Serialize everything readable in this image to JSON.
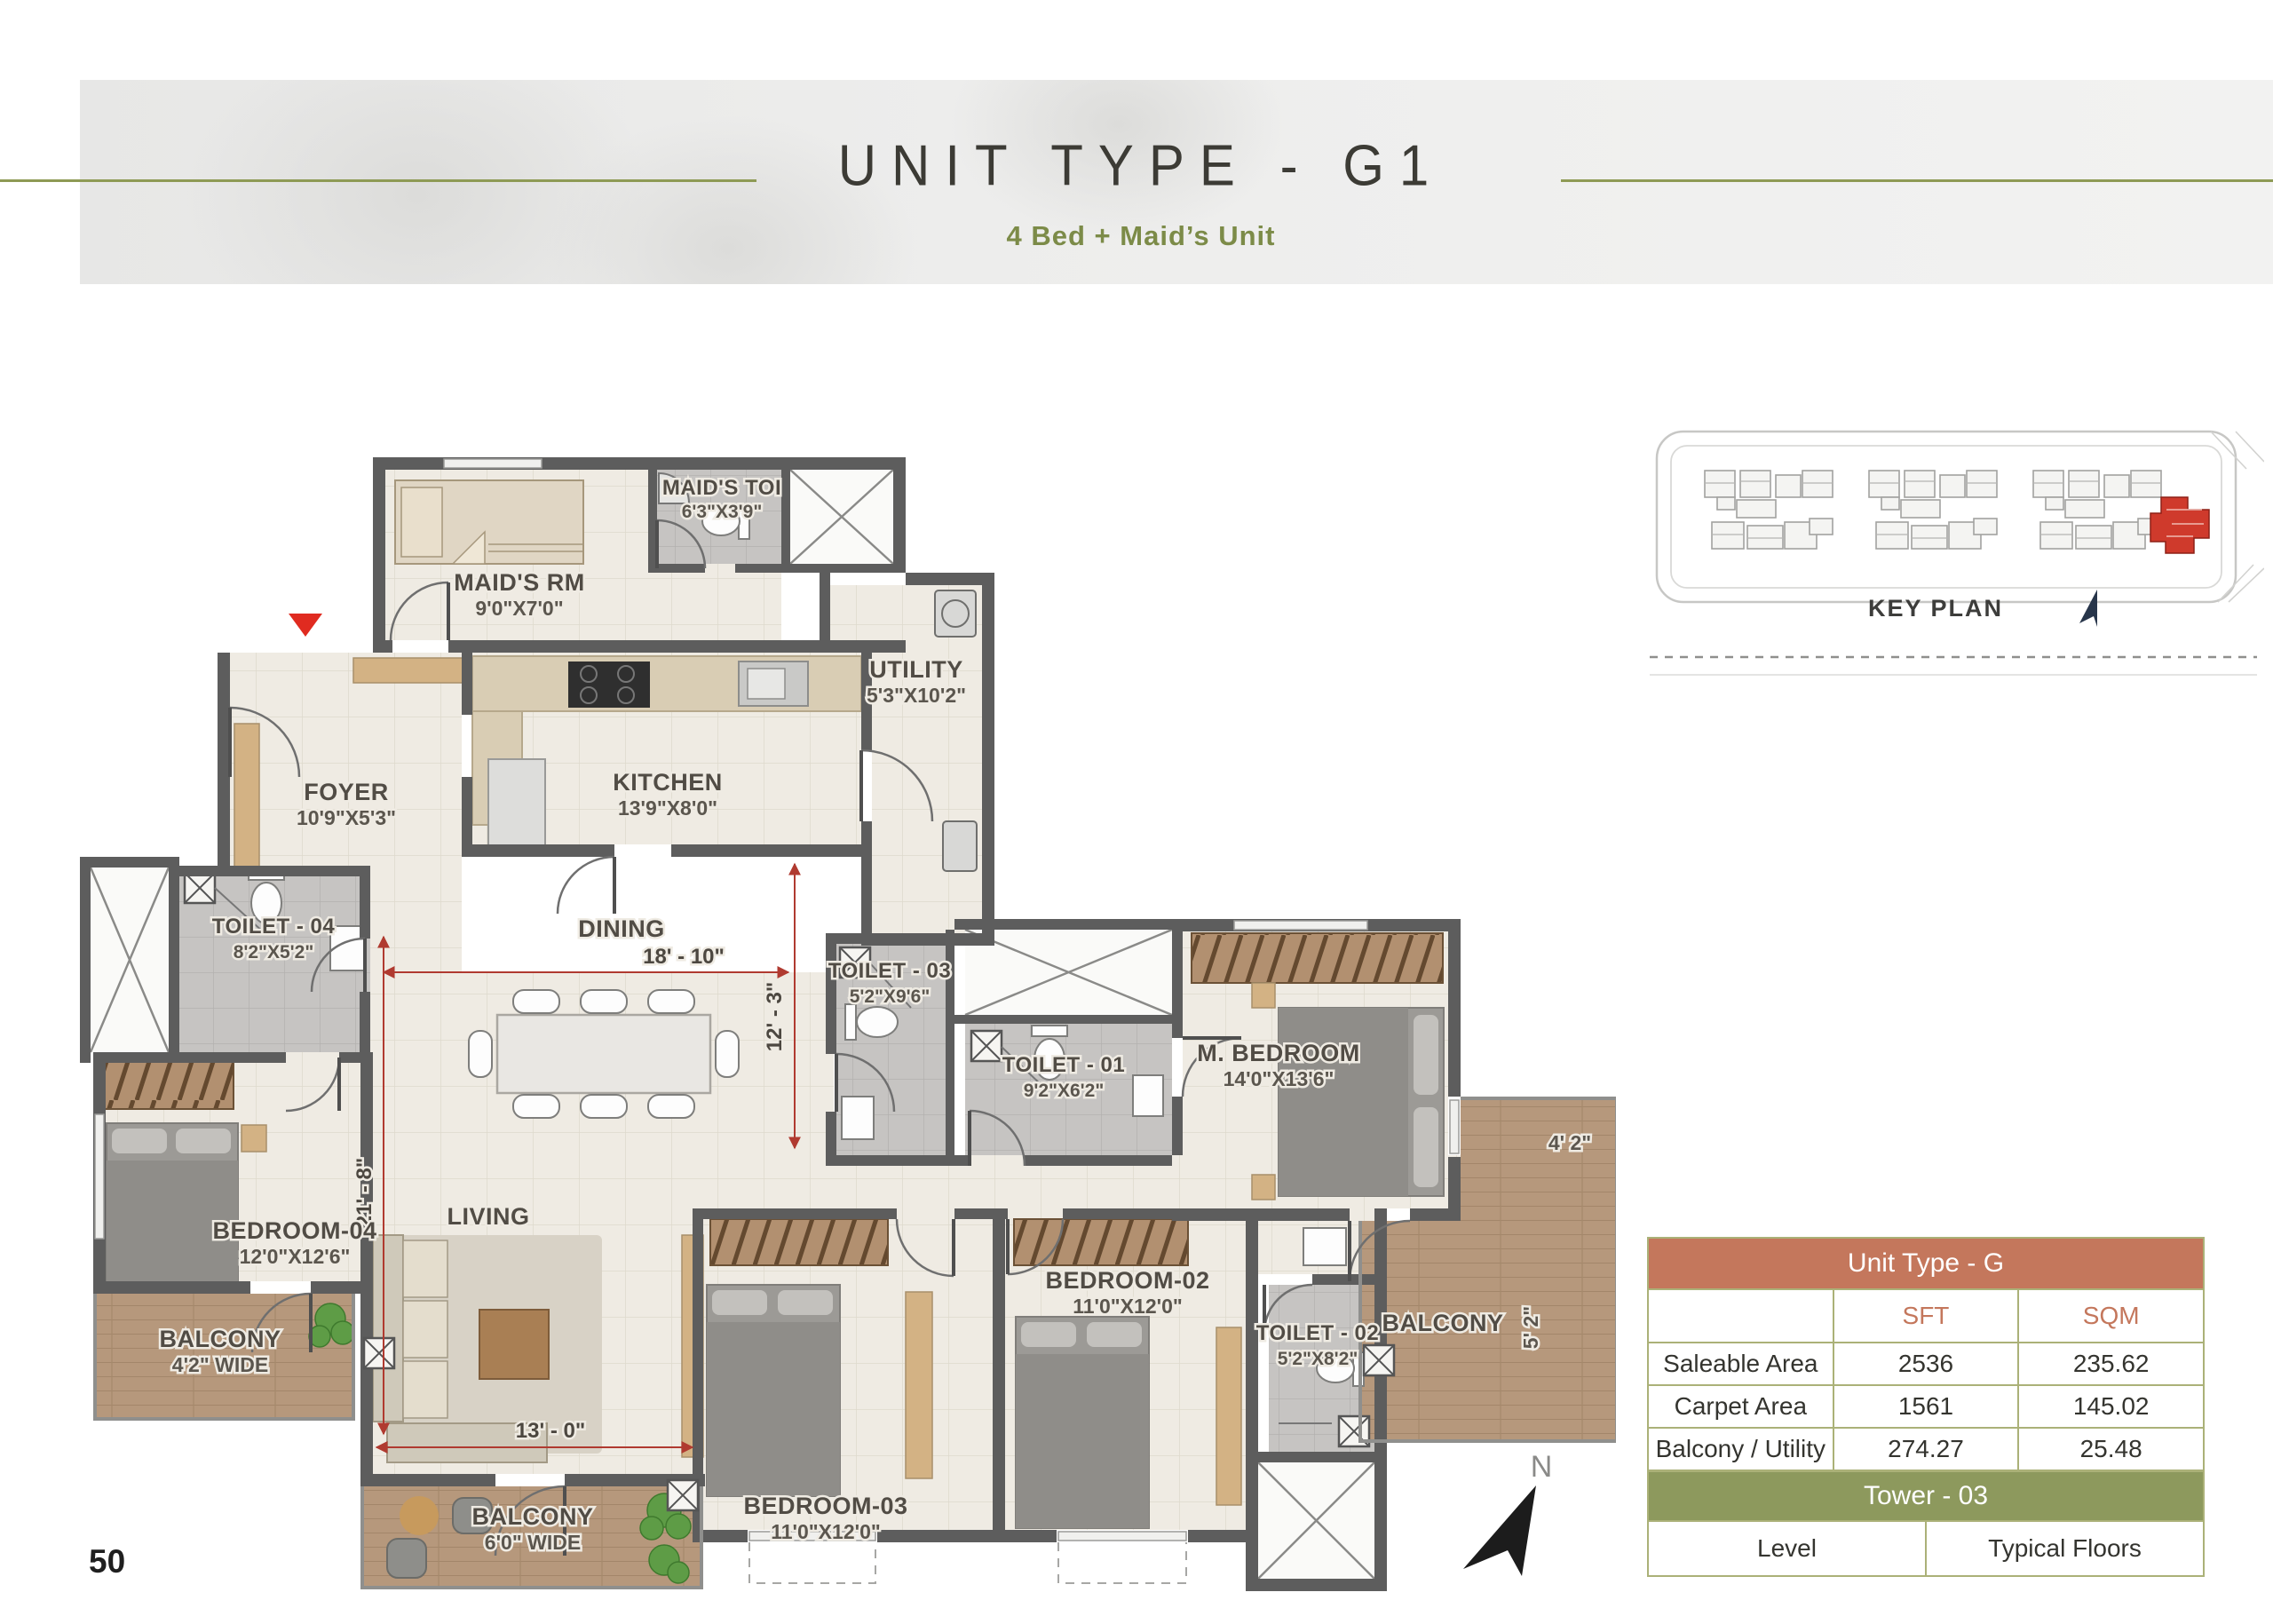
{
  "header": {
    "title": "UNIT TYPE - G1",
    "subtitle": "4 Bed + Maid’s Unit"
  },
  "page": {
    "number": "50"
  },
  "key_plan": {
    "label": "KEY PLAN"
  },
  "north": {
    "label": "N"
  },
  "area_table": {
    "title": "Unit Type - G",
    "col_headers": [
      "",
      "SFT",
      "SQM"
    ],
    "rows": [
      [
        "Saleable Area",
        "2536",
        "235.62"
      ],
      [
        "Carpet Area",
        "1561",
        "145.02"
      ],
      [
        "Balcony / Utility",
        "274.27",
        "25.48"
      ]
    ]
  },
  "tower_table": {
    "title": "Tower - 03",
    "rows": [
      [
        "Level",
        "Typical Floors"
      ]
    ]
  },
  "floor_plan": {
    "rooms": {
      "maids_rm": {
        "name": "MAID'S RM",
        "dims": "9'0\"X7'0\""
      },
      "maids_toi": {
        "name": "MAID'S TOI",
        "dims": "6'3\"X3'9\""
      },
      "utility": {
        "name": "UTILITY",
        "dims": "5'3\"X10'2\""
      },
      "foyer": {
        "name": "FOYER",
        "dims": "10'9\"X5'3\""
      },
      "kitchen": {
        "name": "KITCHEN",
        "dims": "13'9\"X8'0\""
      },
      "dining": {
        "name": "DINING"
      },
      "living": {
        "name": "LIVING"
      },
      "toilet_04": {
        "name": "TOILET - 04",
        "dims": "8'2\"X5'2\""
      },
      "toilet_03": {
        "name": "TOILET - 03",
        "dims": "5'2\"X9'6\""
      },
      "toilet_01": {
        "name": "TOILET - 01",
        "dims": "9'2\"X6'2\""
      },
      "toilet_02": {
        "name": "TOILET - 02",
        "dims": "5'2\"X8'2\""
      },
      "m_bedroom": {
        "name": "M. BEDROOM",
        "dims": "14'0\"X13'6\""
      },
      "bedroom_04": {
        "name": "BEDROOM-04",
        "dims": "12'0\"X12'6\""
      },
      "bedroom_03": {
        "name": "BEDROOM-03",
        "dims": "11'0\"X12'0\""
      },
      "bedroom_02": {
        "name": "BEDROOM-02",
        "dims": "11'0\"X12'0\""
      },
      "balcony_left": {
        "name": "BALCONY",
        "dims": "4'2\" WIDE"
      },
      "balcony_bottom": {
        "name": "BALCONY",
        "dims": "6'0\" WIDE"
      },
      "balcony_right": {
        "name": "BALCONY",
        "dim_a": "4' 2\"",
        "dim_b": "5' 2\""
      }
    },
    "dims": {
      "dining_w": "18' - 10\"",
      "dining_h": "12' - 3\"",
      "living_h": "21' - 8\"",
      "living_w": "13' - 0\""
    }
  },
  "colors": {
    "accent_terracotta": "#c4775c",
    "accent_olive": "#8d995d",
    "table_border": "#abb178",
    "rule_olive": "#8e9a55",
    "dim_red": "#b03a30",
    "wall_gray": "#5d5d5d"
  }
}
